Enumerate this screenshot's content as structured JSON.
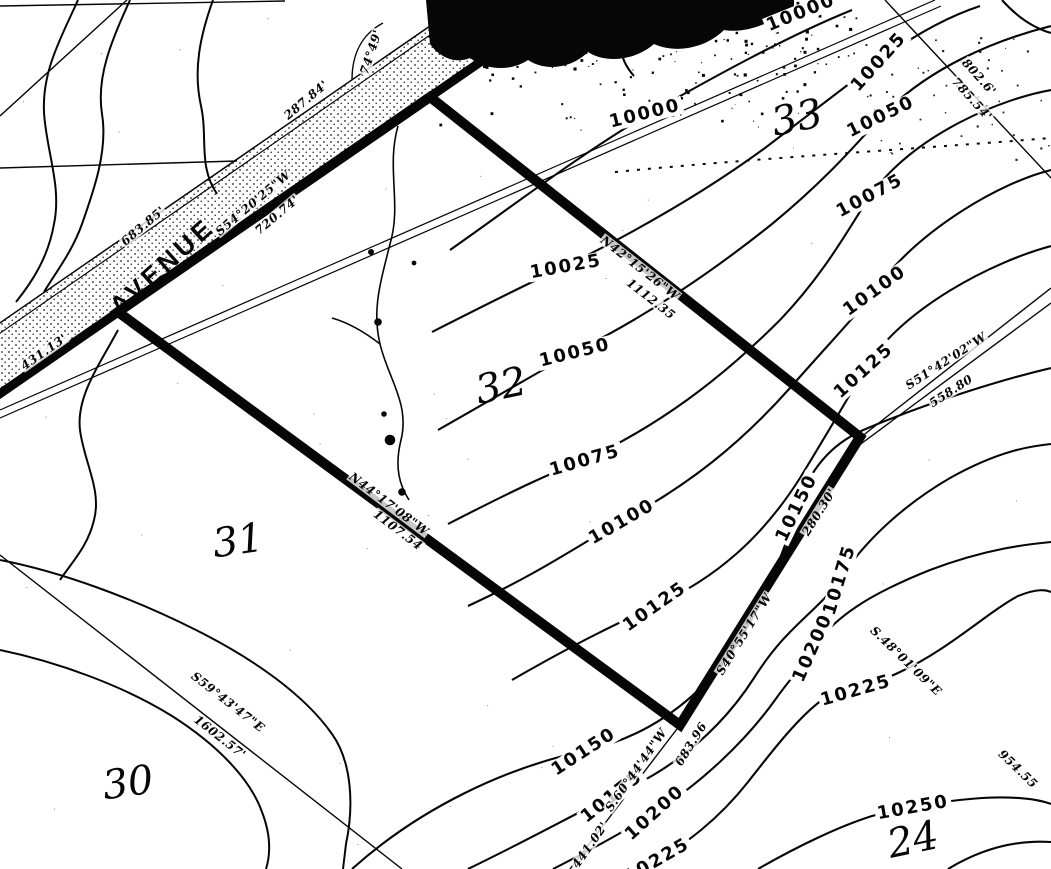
{
  "map": {
    "kind": "survey-plat-topographic-map",
    "road_label": "AVENUE",
    "ink_color": "#060606",
    "paper_color": "#ffffff",
    "contour_interval": 25,
    "contour_elevations": [
      10000,
      10025,
      10050,
      10075,
      10100,
      10125,
      10150,
      10175,
      10200,
      10225,
      10250
    ],
    "section_numbers": [
      "30",
      "31",
      "32",
      "33",
      "24"
    ]
  },
  "labels": [
    {
      "kind": "contour",
      "text": "10000",
      "x": 645,
      "y": 114,
      "rot": -14
    },
    {
      "kind": "contour",
      "text": "10000",
      "x": 801,
      "y": 13,
      "rot": -22
    },
    {
      "kind": "contour",
      "text": "10025",
      "x": 566,
      "y": 267,
      "rot": -10
    },
    {
      "kind": "contour",
      "text": "10025",
      "x": 879,
      "y": 62,
      "rot": -48
    },
    {
      "kind": "contour",
      "text": "10050",
      "x": 575,
      "y": 353,
      "rot": -14
    },
    {
      "kind": "contour",
      "text": "10050",
      "x": 881,
      "y": 117,
      "rot": -26
    },
    {
      "kind": "contour",
      "text": "10075",
      "x": 585,
      "y": 461,
      "rot": -16
    },
    {
      "kind": "contour",
      "text": "10075",
      "x": 870,
      "y": 196,
      "rot": -28
    },
    {
      "kind": "contour",
      "text": "10100",
      "x": 622,
      "y": 522,
      "rot": -30
    },
    {
      "kind": "contour",
      "text": "10100",
      "x": 875,
      "y": 291,
      "rot": -36
    },
    {
      "kind": "contour",
      "text": "10125",
      "x": 655,
      "y": 607,
      "rot": -35
    },
    {
      "kind": "contour",
      "text": "10125",
      "x": 864,
      "y": 371,
      "rot": -42
    },
    {
      "kind": "contour",
      "text": "10150",
      "x": 584,
      "y": 752,
      "rot": -33
    },
    {
      "kind": "contour",
      "text": "10150",
      "x": 797,
      "y": 508,
      "rot": -64
    },
    {
      "kind": "contour",
      "text": "10175",
      "x": 612,
      "y": 797,
      "rot": -38
    },
    {
      "kind": "contour",
      "text": "10175",
      "x": 840,
      "y": 580,
      "rot": -73
    },
    {
      "kind": "contour",
      "text": "10200",
      "x": 655,
      "y": 813,
      "rot": -42
    },
    {
      "kind": "contour",
      "text": "10200",
      "x": 813,
      "y": 648,
      "rot": -66
    },
    {
      "kind": "contour",
      "text": "10225",
      "x": 856,
      "y": 691,
      "rot": -16
    },
    {
      "kind": "contour",
      "text": "10225",
      "x": 657,
      "y": 861,
      "rot": -30
    },
    {
      "kind": "contour",
      "text": "10250",
      "x": 913,
      "y": 808,
      "rot": -10
    },
    {
      "kind": "section",
      "text": "33",
      "x": 797,
      "y": 118,
      "rot": -12
    },
    {
      "kind": "section",
      "text": "32",
      "x": 501,
      "y": 386,
      "rot": -12
    },
    {
      "kind": "section",
      "text": "31",
      "x": 238,
      "y": 541,
      "rot": -8
    },
    {
      "kind": "section",
      "text": "30",
      "x": 128,
      "y": 783,
      "rot": -8
    },
    {
      "kind": "section",
      "text": "24",
      "x": 913,
      "y": 840,
      "rot": -12
    },
    {
      "kind": "bearing",
      "text": "287.84'",
      "x": 306,
      "y": 100,
      "rot": -40
    },
    {
      "kind": "bearing",
      "text": "74°49'",
      "x": 371,
      "y": 52,
      "rot": -72
    },
    {
      "kind": "bearing",
      "text": "683.85'",
      "x": 143,
      "y": 226,
      "rot": -40
    },
    {
      "kind": "bearing",
      "text": "S54°20'25\"W",
      "x": 253,
      "y": 203,
      "rot": -40
    },
    {
      "kind": "bearing",
      "text": "720.74'",
      "x": 277,
      "y": 215,
      "rot": -40
    },
    {
      "kind": "bearing",
      "text": "431.13'",
      "x": 44,
      "y": 352,
      "rot": -35
    },
    {
      "kind": "bearing",
      "text": "N42°15'26\"W",
      "x": 640,
      "y": 268,
      "rot": 38
    },
    {
      "kind": "bearing",
      "text": "1112.35",
      "x": 651,
      "y": 299,
      "rot": 38
    },
    {
      "kind": "bearing",
      "text": "S51°42'02\"W",
      "x": 946,
      "y": 361,
      "rot": -33
    },
    {
      "kind": "bearing",
      "text": "558.80",
      "x": 951,
      "y": 391,
      "rot": -33
    },
    {
      "kind": "bearing",
      "text": "802.6'",
      "x": 979,
      "y": 77,
      "rot": 48
    },
    {
      "kind": "bearing",
      "text": "785.54'",
      "x": 972,
      "y": 99,
      "rot": 48
    },
    {
      "kind": "bearing",
      "text": "S59°43'47\"E",
      "x": 228,
      "y": 702,
      "rot": 38
    },
    {
      "kind": "bearing",
      "text": "1602.57'",
      "x": 220,
      "y": 737,
      "rot": 38
    },
    {
      "kind": "bearing",
      "text": "N44°17'08\"W",
      "x": 389,
      "y": 504,
      "rot": 37
    },
    {
      "kind": "bearing",
      "text": "1107.54",
      "x": 398,
      "y": 530,
      "rot": 37
    },
    {
      "kind": "bearing",
      "text": "S40°55'17\"W",
      "x": 744,
      "y": 634,
      "rot": -58
    },
    {
      "kind": "bearing",
      "text": "683.96",
      "x": 691,
      "y": 744,
      "rot": -58
    },
    {
      "kind": "bearing",
      "text": "280.30'",
      "x": 819,
      "y": 512,
      "rot": -58
    },
    {
      "kind": "bearing",
      "text": "S.60°44'44\"W",
      "x": 636,
      "y": 770,
      "rot": -55
    },
    {
      "kind": "bearing",
      "text": "441.02'",
      "x": 590,
      "y": 845,
      "rot": -55
    },
    {
      "kind": "bearing",
      "text": "S.48°01'09\"E",
      "x": 906,
      "y": 661,
      "rot": 44
    },
    {
      "kind": "bearing",
      "text": "954.55",
      "x": 1018,
      "y": 769,
      "rot": 44
    },
    {
      "kind": "road",
      "text": "AVENUE",
      "x": 162,
      "y": 266,
      "rot": -42
    }
  ]
}
